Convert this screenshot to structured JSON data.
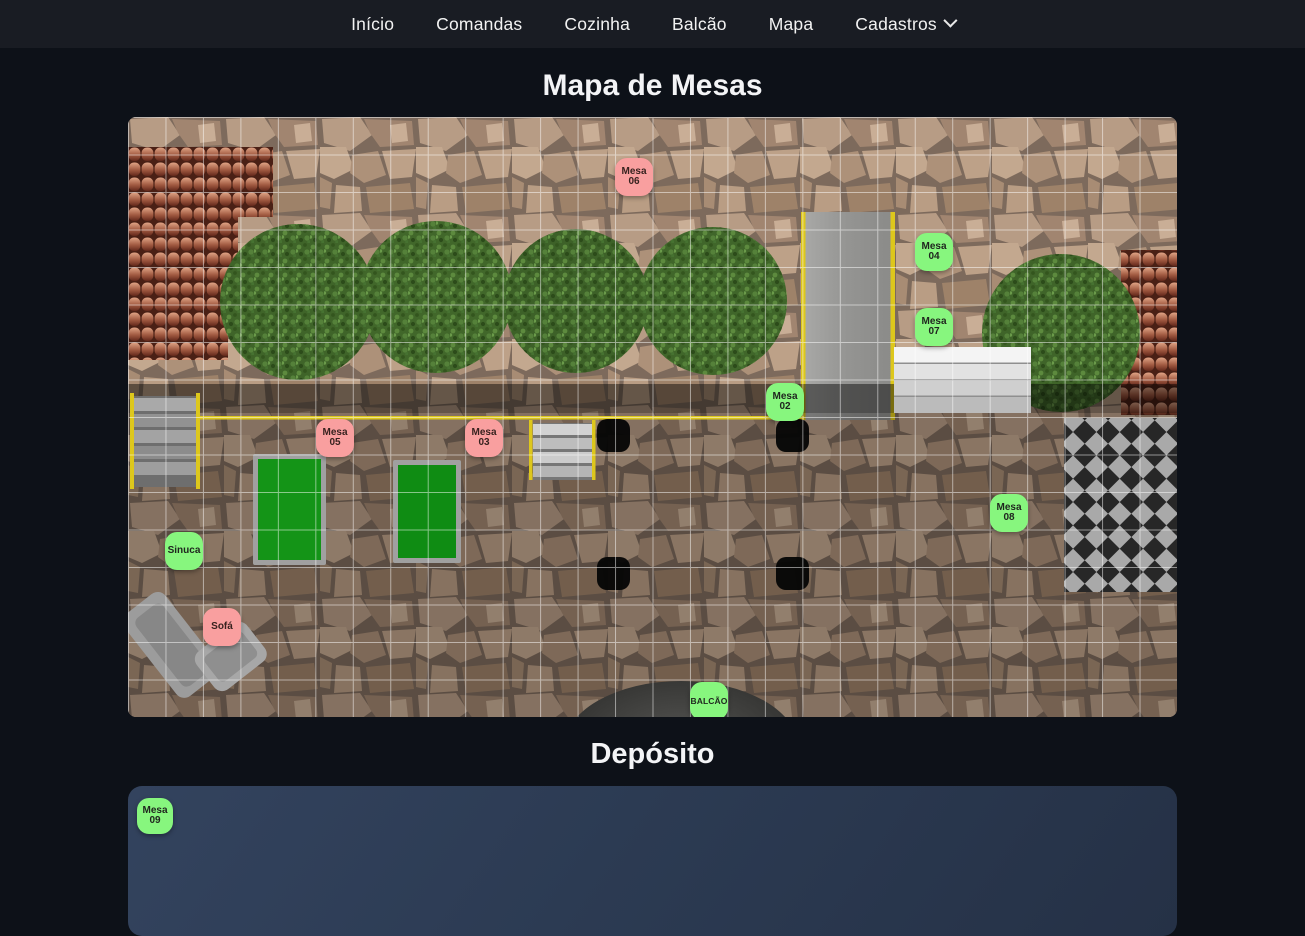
{
  "nav": {
    "items": [
      {
        "label": "Início",
        "dropdown": false
      },
      {
        "label": "Comandas",
        "dropdown": false
      },
      {
        "label": "Cozinha",
        "dropdown": false
      },
      {
        "label": "Balcão",
        "dropdown": false
      },
      {
        "label": "Mapa",
        "dropdown": false
      },
      {
        "label": "Cadastros",
        "dropdown": true
      }
    ]
  },
  "headings": {
    "map_title": "Mapa de Mesas",
    "deposito_title": "Depósito"
  },
  "status_colors": {
    "available": "#87f67e",
    "occupied": "#f99f9f"
  },
  "map": {
    "tables": [
      {
        "label": "Mesa 06",
        "status": "occupied",
        "x": 487,
        "y": 41
      },
      {
        "label": "Mesa 04",
        "status": "available",
        "x": 787,
        "y": 116
      },
      {
        "label": "Mesa 07",
        "status": "available",
        "x": 787,
        "y": 191
      },
      {
        "label": "Mesa 02",
        "status": "available",
        "x": 638,
        "y": 266
      },
      {
        "label": "Mesa 05",
        "status": "occupied",
        "x": 188,
        "y": 302
      },
      {
        "label": "Mesa 03",
        "status": "occupied",
        "x": 337,
        "y": 302
      },
      {
        "label": "Mesa 08",
        "status": "available",
        "x": 862,
        "y": 377
      },
      {
        "label": "Sinuca",
        "status": "available",
        "x": 37,
        "y": 415
      },
      {
        "label": "Sofá",
        "status": "occupied",
        "x": 75,
        "y": 491
      },
      {
        "label": "BALCÃO",
        "status": "available",
        "x": 562,
        "y": 565,
        "small": true
      }
    ]
  },
  "deposito": {
    "tables": [
      {
        "label": "Mesa 09",
        "status": "available",
        "x": 9,
        "y": 12
      }
    ]
  }
}
